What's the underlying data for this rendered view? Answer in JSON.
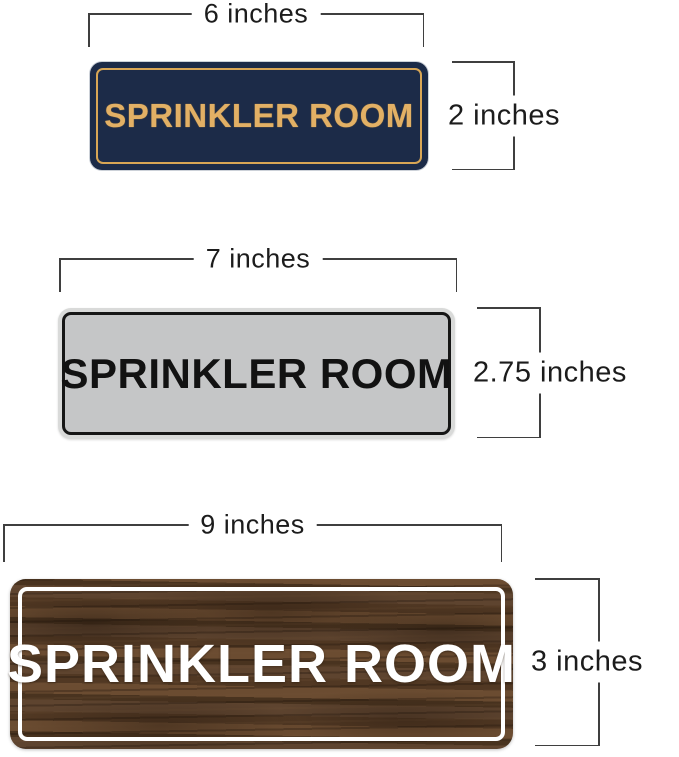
{
  "page": {
    "background": "#ffffff",
    "dimension_line_color": "#3f3f3f",
    "dimension_text_color": "#1c1c1c"
  },
  "signs": [
    {
      "id": "navy-gold",
      "label": "SPRINKLER ROOM",
      "width_label": "6 inches",
      "height_label": "2 inches",
      "colors": {
        "background": "#1c2b48",
        "text": "#e2b065",
        "border": "#d8a655"
      }
    },
    {
      "id": "silver-black",
      "label": "SPRINKLER ROOM",
      "width_label": "7 inches",
      "height_label": "2.75 inches",
      "colors": {
        "background": "#c5c6c7",
        "rim": "#d9dad9",
        "text": "#121212",
        "border": "#161616"
      }
    },
    {
      "id": "walnut-wood",
      "label": "SPRINKLER ROOM",
      "width_label": "9 inches",
      "height_label": "3 inches",
      "colors": {
        "background": "#553b2a",
        "text": "#ffffff",
        "border": "#ffffff"
      }
    }
  ]
}
